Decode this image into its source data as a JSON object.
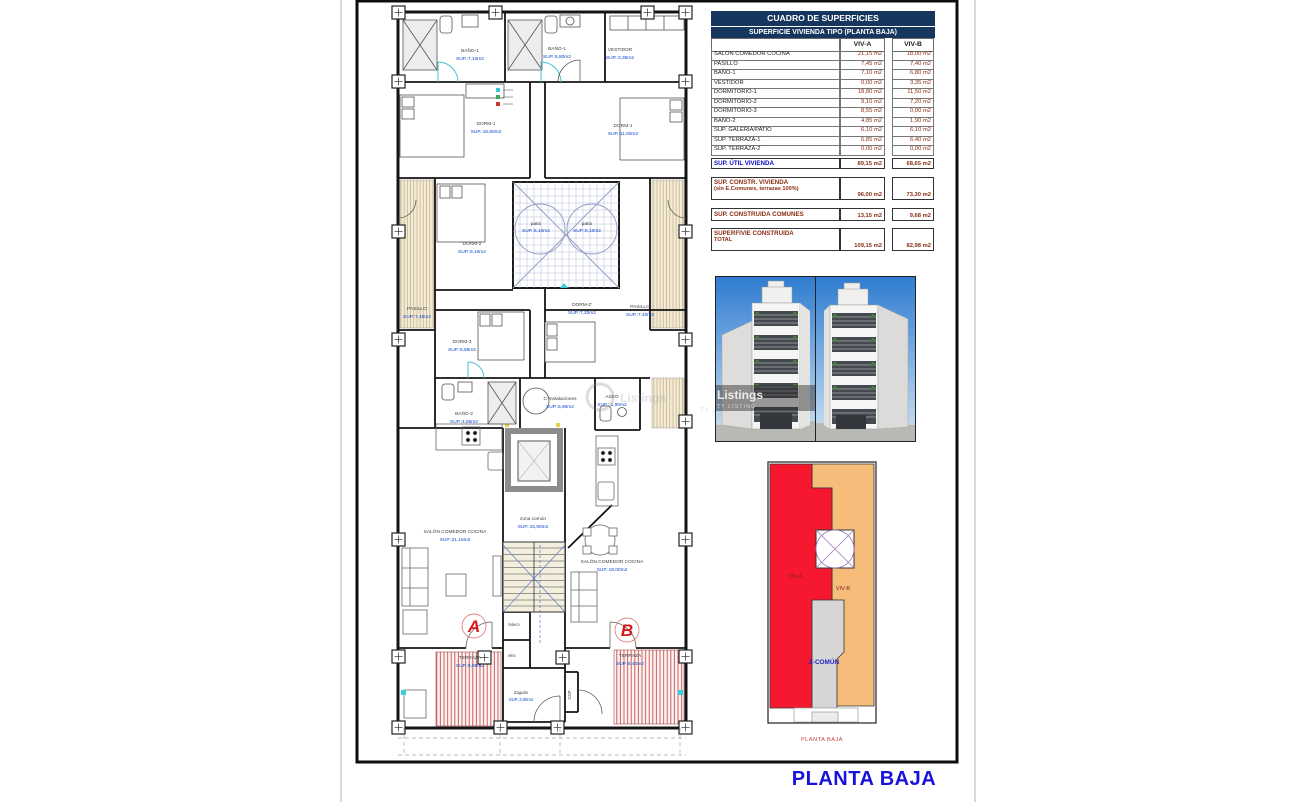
{
  "page": {
    "bottom_title": "PLANTA BAJA"
  },
  "table": {
    "title": "CUADRO DE SUPERFICIES",
    "subtitle": "SUPERFICIE VIVIENDA TIPO  (PLANTA BAJA)",
    "columns": {
      "a": "VIV-A",
      "b": "VIV-B"
    },
    "rows": [
      {
        "label": "SALON COMEDOR COCINA",
        "a": "21,15 m2",
        "b": "18,00 m2"
      },
      {
        "label": "PASILLO",
        "a": "7,45 m2",
        "b": "7,40 m2"
      },
      {
        "label": "BAÑO-1",
        "a": "7,10 m2",
        "b": "6,80 m2"
      },
      {
        "label": "VESTIDOR",
        "a": "0,00 m2",
        "b": "3,35 m2"
      },
      {
        "label": "DORMITORIO-1",
        "a": "18,80 m2",
        "b": "11,50 m2"
      },
      {
        "label": "DORMITORIO-2",
        "a": "9,10 m2",
        "b": "7,20 m2"
      },
      {
        "label": "DORMITORIO-3",
        "a": "8,55 m2",
        "b": "0,00 m2"
      },
      {
        "label": "BAÑO-2",
        "a": "4,85 m2",
        "b": "1,90 m2"
      },
      {
        "label": "SUP. GALERIA/PATIO",
        "a": "6,10 m2",
        "b": "6,10 m2"
      },
      {
        "label": "SUP. TERRAZA-1",
        "a": "6,85 m2",
        "b": "6,40 m2"
      },
      {
        "label": "SUP. TERRAZA-2",
        "a": "0,00 m2",
        "b": "0,00 m2"
      }
    ],
    "summary": [
      {
        "label": "SUP. ÚTIL VIVIENDA",
        "label2": "",
        "a": "89,15 m2",
        "b": "68,65 m2"
      },
      {
        "label": "SUP. CONSTR. VIVIENDA",
        "label2": "(sin E.Comunes, terrazas 100%)",
        "a": "96,00 m2",
        "b": "73,30 m2"
      },
      {
        "label": "SUP. CONSTRUIDA COMUNES",
        "label2": "",
        "a": "13,15 m2",
        "b": "9,68 m2"
      },
      {
        "label": "SUPERFIVIE CONSTRUIDA",
        "label2": "TOTAL",
        "a": "109,15 m2",
        "b": "82,98 m2"
      }
    ]
  },
  "plan": {
    "rooms": [
      {
        "name": "BAÑO-1",
        "sup": "SUP.:7,10m2"
      },
      {
        "name": "BAÑO-1",
        "sup": "SUP.:6,80m2"
      },
      {
        "name": "VESTIDOR",
        "sup": "SUP.:3,35m2"
      },
      {
        "name": "DORM-1",
        "sup": "SUP.:18,80m2"
      },
      {
        "name": "DORM-1",
        "sup": "SUP.:11,50m2"
      },
      {
        "name": "DORM-2",
        "sup": "SUP.:9,10m2"
      },
      {
        "name": "patio",
        "sup": "SUP.:6,10m2"
      },
      {
        "name": "patio",
        "sup": "SUP.:6,10m2"
      },
      {
        "name": "PASILLO",
        "sup": "SUP.:7,45m2"
      },
      {
        "name": "PASILLO",
        "sup": "SUP.:7,40m2"
      },
      {
        "name": "DORM-3",
        "sup": "SUP.:8,55m2"
      },
      {
        "name": "DORM-2'",
        "sup": "SUP.:7,20m2"
      },
      {
        "name": "BAÑO-2",
        "sup": "SUP.:4,85m2"
      },
      {
        "name": "C-Instalaciones",
        "sup": "SUP.:5,90m2"
      },
      {
        "name": "ASEO",
        "sup": "SUP.: 1,90m2"
      },
      {
        "name": "zona común",
        "sup": "SUP.:15,90m2"
      },
      {
        "name": "SALÓN COMEDOR COCINA",
        "sup": "SUP.:21,15m2"
      },
      {
        "name": "SALÓN COMEDOR COCINA",
        "sup": "SUP.:18,00m2"
      },
      {
        "name": "TERRAZA",
        "sup": "SUP.:6,85m2"
      },
      {
        "name": "TERRAZA",
        "sup": "SUP.:6,40m2"
      }
    ],
    "letters": {
      "a": "A",
      "b": "B"
    },
    "small": {
      "teleco": "teleco",
      "elec": "elec",
      "cgp": "CGP",
      "zaguan": "Zaguán",
      "zaguan_sup": "SUP.:3,00m2"
    }
  },
  "keyplan": {
    "viv_a": "VIV-A",
    "viv_b": "VIV-B",
    "z_comun": "Z-COMÚN",
    "caption": "PLANTA BAJA"
  },
  "watermark": {
    "line1": "Listings",
    "line2": "TY LISTING"
  },
  "colors": {
    "table_header_bg": "#17365d",
    "value_text": "#8a2d12",
    "blue_label": "#0707c0",
    "plan_sup_text": "#0a46c8",
    "keyplan_viv_a": "#f5182e",
    "keyplan_viv_b": "#f5bc7a",
    "keyplan_comun": "#d6d6d6",
    "bottom_title": "#1713dd",
    "letter_red": "#d81818"
  }
}
